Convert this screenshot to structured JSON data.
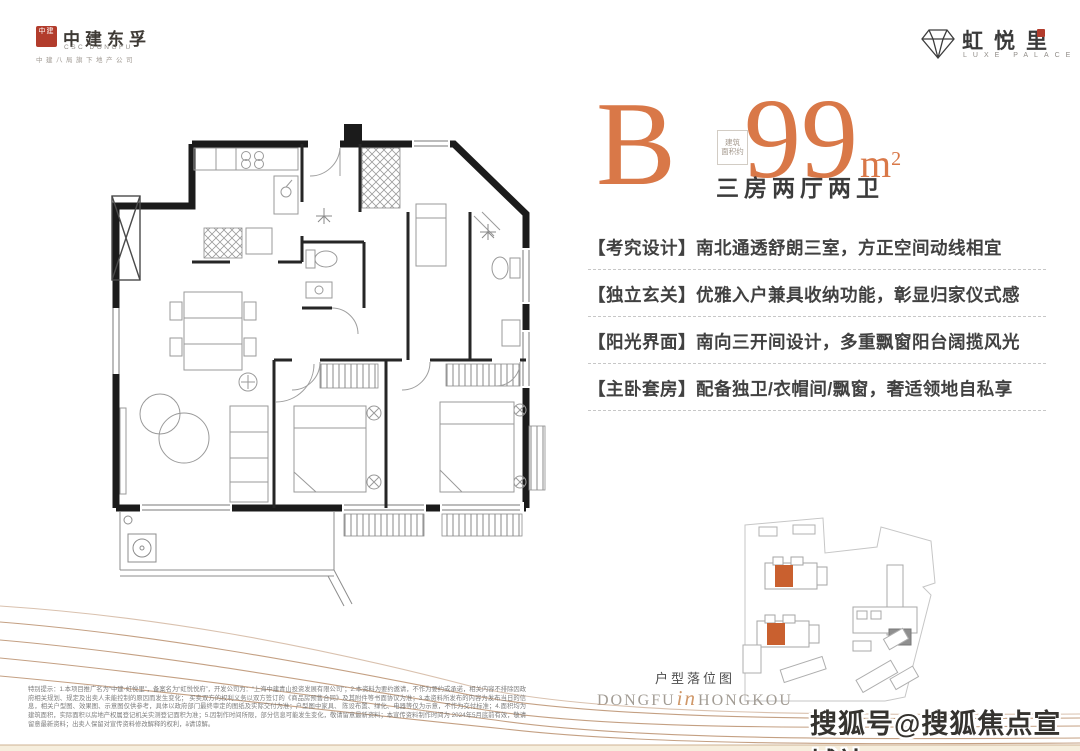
{
  "header": {
    "left_logo": {
      "seal": "中建",
      "title": "中建东孚",
      "subtitle": "CSC DONGFU",
      "tagline": "中建八局旗下地产公司"
    },
    "right_logo": {
      "title": "虹悦里",
      "subtitle": "LUXE PALACE"
    }
  },
  "unit": {
    "type_letter": "B",
    "area_note_line1": "建筑",
    "area_note_line2": "面积约",
    "area_value": "99",
    "area_unit_base": "m",
    "area_unit_sup": "2",
    "rooms": "三房两厅两卫"
  },
  "features": [
    {
      "text": "【考究设计】南北通透舒朗三室，方正空间动线相宜"
    },
    {
      "text": "【独立玄关】优雅入户兼具收纳功能，彰显归家仪式感"
    },
    {
      "text": "【阳光界面】南向三开间设计，多重飘窗阳台阔揽风光"
    },
    {
      "text": "【主卧套房】配备独卫/衣帽间/飘窗，奢适领地自私享"
    }
  ],
  "siteplan": {
    "caption": "户型落位图",
    "brand_left": "DONGFU",
    "brand_mid": "in",
    "brand_right": "HONGKOU"
  },
  "disclaimer": {
    "lines": [
      "特别提示：1.本项目推广名为“中建·虹悦里”，备案名为“虹悦悦府”，开发公司为：“上海中建青山投资发展有限公司”；2.本资料为要约邀请，不作为要约或承诺，相关内容不排除因政府相关规划、规定及出卖人未能控制的原因而发生变化；",
      "买卖双方的权利义务以双方签订的《商品房预售合同》及其附件等书面协议为准；3.本资料所发布的内容为发布当日的信息，相关户型图、效果图、示意图仅供参考，具体以政府部门最终审定的图纸及实际交付为准；户型图中家具、",
      "陈设布置、绿化、电器等仅为示意，不作为交付标准；4.面积均为建筑面积，实际面积以房地产权属登记机关实测登记面积为准；5.因制作时间所限，部分信息可能发生变化，敬请留意最新资料；本宣传资料制作时间为",
      "2024年5月底前有效，敬请留意最新资料；出卖人保留对宣传资料修改解释的权利，ặ请谅解。"
    ]
  },
  "watermark": "搜狐号@搜狐焦点宣城站"
}
